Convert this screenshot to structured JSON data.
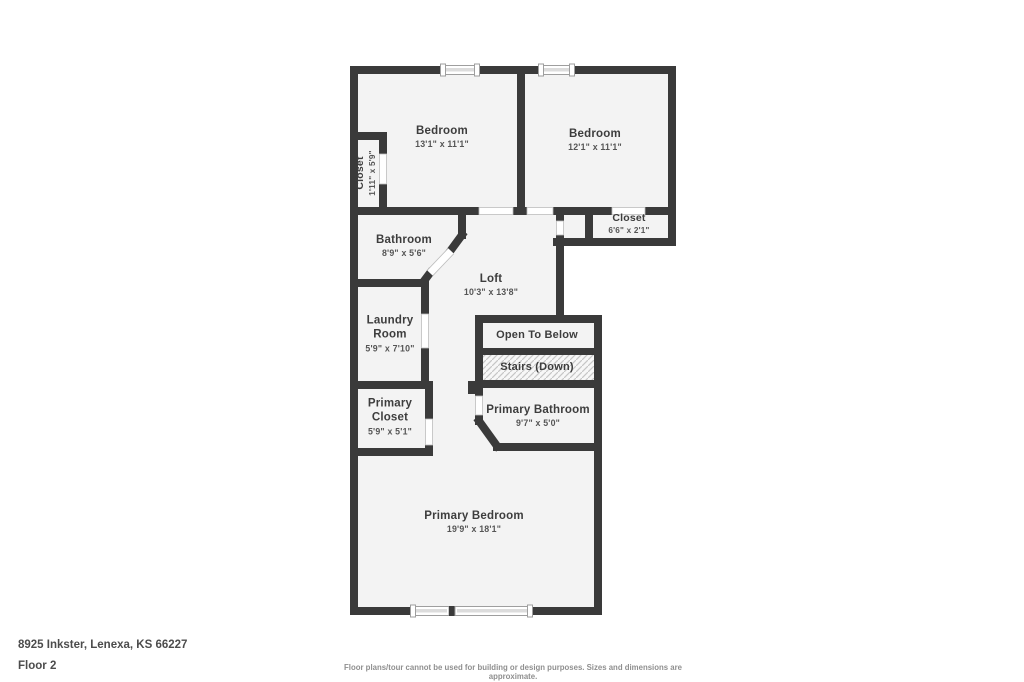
{
  "plan": {
    "rooms": [
      {
        "name": "Bedroom",
        "dims": "13'1\" x 11'1\""
      },
      {
        "name": "Bedroom",
        "dims": "12'1\" x 11'1\""
      },
      {
        "name": "Closet",
        "dims": "1'11\" x 5'9\""
      },
      {
        "name": "Bathroom",
        "dims": "8'9\" x 5'6\""
      },
      {
        "name": "Closet",
        "dims": "6'6\" x 2'1\""
      },
      {
        "name": "Loft",
        "dims": "10'3\" x 13'8\""
      },
      {
        "name": "Laundry Room",
        "dims": "5'9\" x 7'10\""
      },
      {
        "name": "Open To Below"
      },
      {
        "name": "Stairs (Down)"
      },
      {
        "name": "Primary Closet",
        "dims": "5'9\" x 5'1\""
      },
      {
        "name": "Primary Bathroom",
        "dims": "9'7\" x 5'0\""
      },
      {
        "name": "Primary Bedroom",
        "dims": "19'9\" x 18'1\""
      }
    ],
    "colors": {
      "wall": "#3a3a3a",
      "floor": "#f3f3f3",
      "door": "#ffffff",
      "door_outline": "#bdbdbd",
      "window_border": "#9e9e9e",
      "window_pane": "#dcdcdc",
      "stairs_hatch": "#c6c6c6",
      "label_text": "#3d3d3d"
    }
  },
  "footer": {
    "address": "8925 Inkster, Lenexa, KS 66227",
    "floor_label": "Floor 2",
    "disclaimer": "Floor plans/tour cannot be used for building or design purposes. Sizes and dimensions are approximate."
  }
}
